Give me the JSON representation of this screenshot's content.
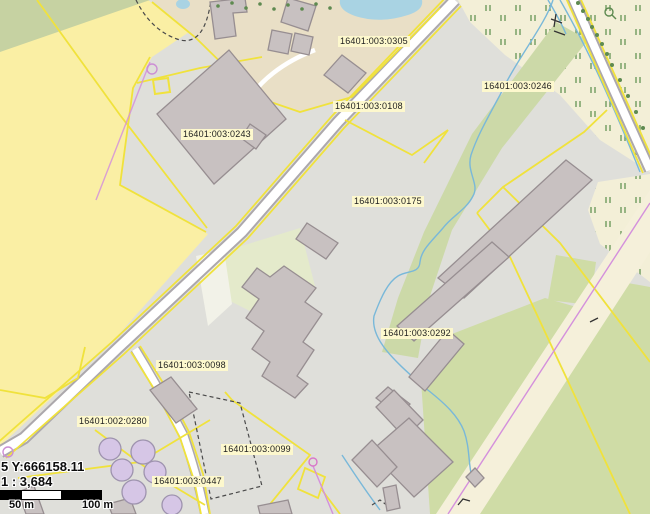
{
  "map": {
    "parcel_labels": [
      {
        "text": "16401:003:0305",
        "x": 338,
        "y": 36
      },
      {
        "text": "16401:003:0108",
        "x": 333,
        "y": 101
      },
      {
        "text": "16401:003:0246",
        "x": 482,
        "y": 81
      },
      {
        "text": "16401:003:0243",
        "x": 181,
        "y": 129
      },
      {
        "text": "16401:003:0175",
        "x": 352,
        "y": 196
      },
      {
        "text": "16401:003:0292",
        "x": 381,
        "y": 328
      },
      {
        "text": "16401:003:0098",
        "x": 156,
        "y": 360
      },
      {
        "text": "16401:002:0280",
        "x": 77,
        "y": 416
      },
      {
        "text": "16401:003:0099",
        "x": 221,
        "y": 444
      },
      {
        "text": "16401:003:0447",
        "x": 152,
        "y": 476
      }
    ],
    "overlay": {
      "coordinates": "5 Y:666158.11",
      "scale_ratio": "1 : 3,684",
      "scalebar": {
        "label_mid": "50 m",
        "label_end": "100 m"
      }
    },
    "colors": {
      "field_yellow": "#faefa4",
      "scrub_cream": "#f3efd7",
      "farmyard_tan": "#e9dfc6",
      "yard_gray": "#dfdfda",
      "building_fill": "#c8c1c1",
      "building_stroke": "#978e91",
      "parcel_line_yellow": "#f0e23c",
      "road_fill": "#ffffff",
      "road_casing": "#aca8ac",
      "water_blue": "#a9d3e3",
      "ditch_blue": "#79b8d9",
      "powerline_magenta": "#d490dc",
      "vegetation_green": "#ccd9a8",
      "tree_mark_green": "#6e9a5e",
      "label_bg": "#fdf8cd"
    }
  }
}
